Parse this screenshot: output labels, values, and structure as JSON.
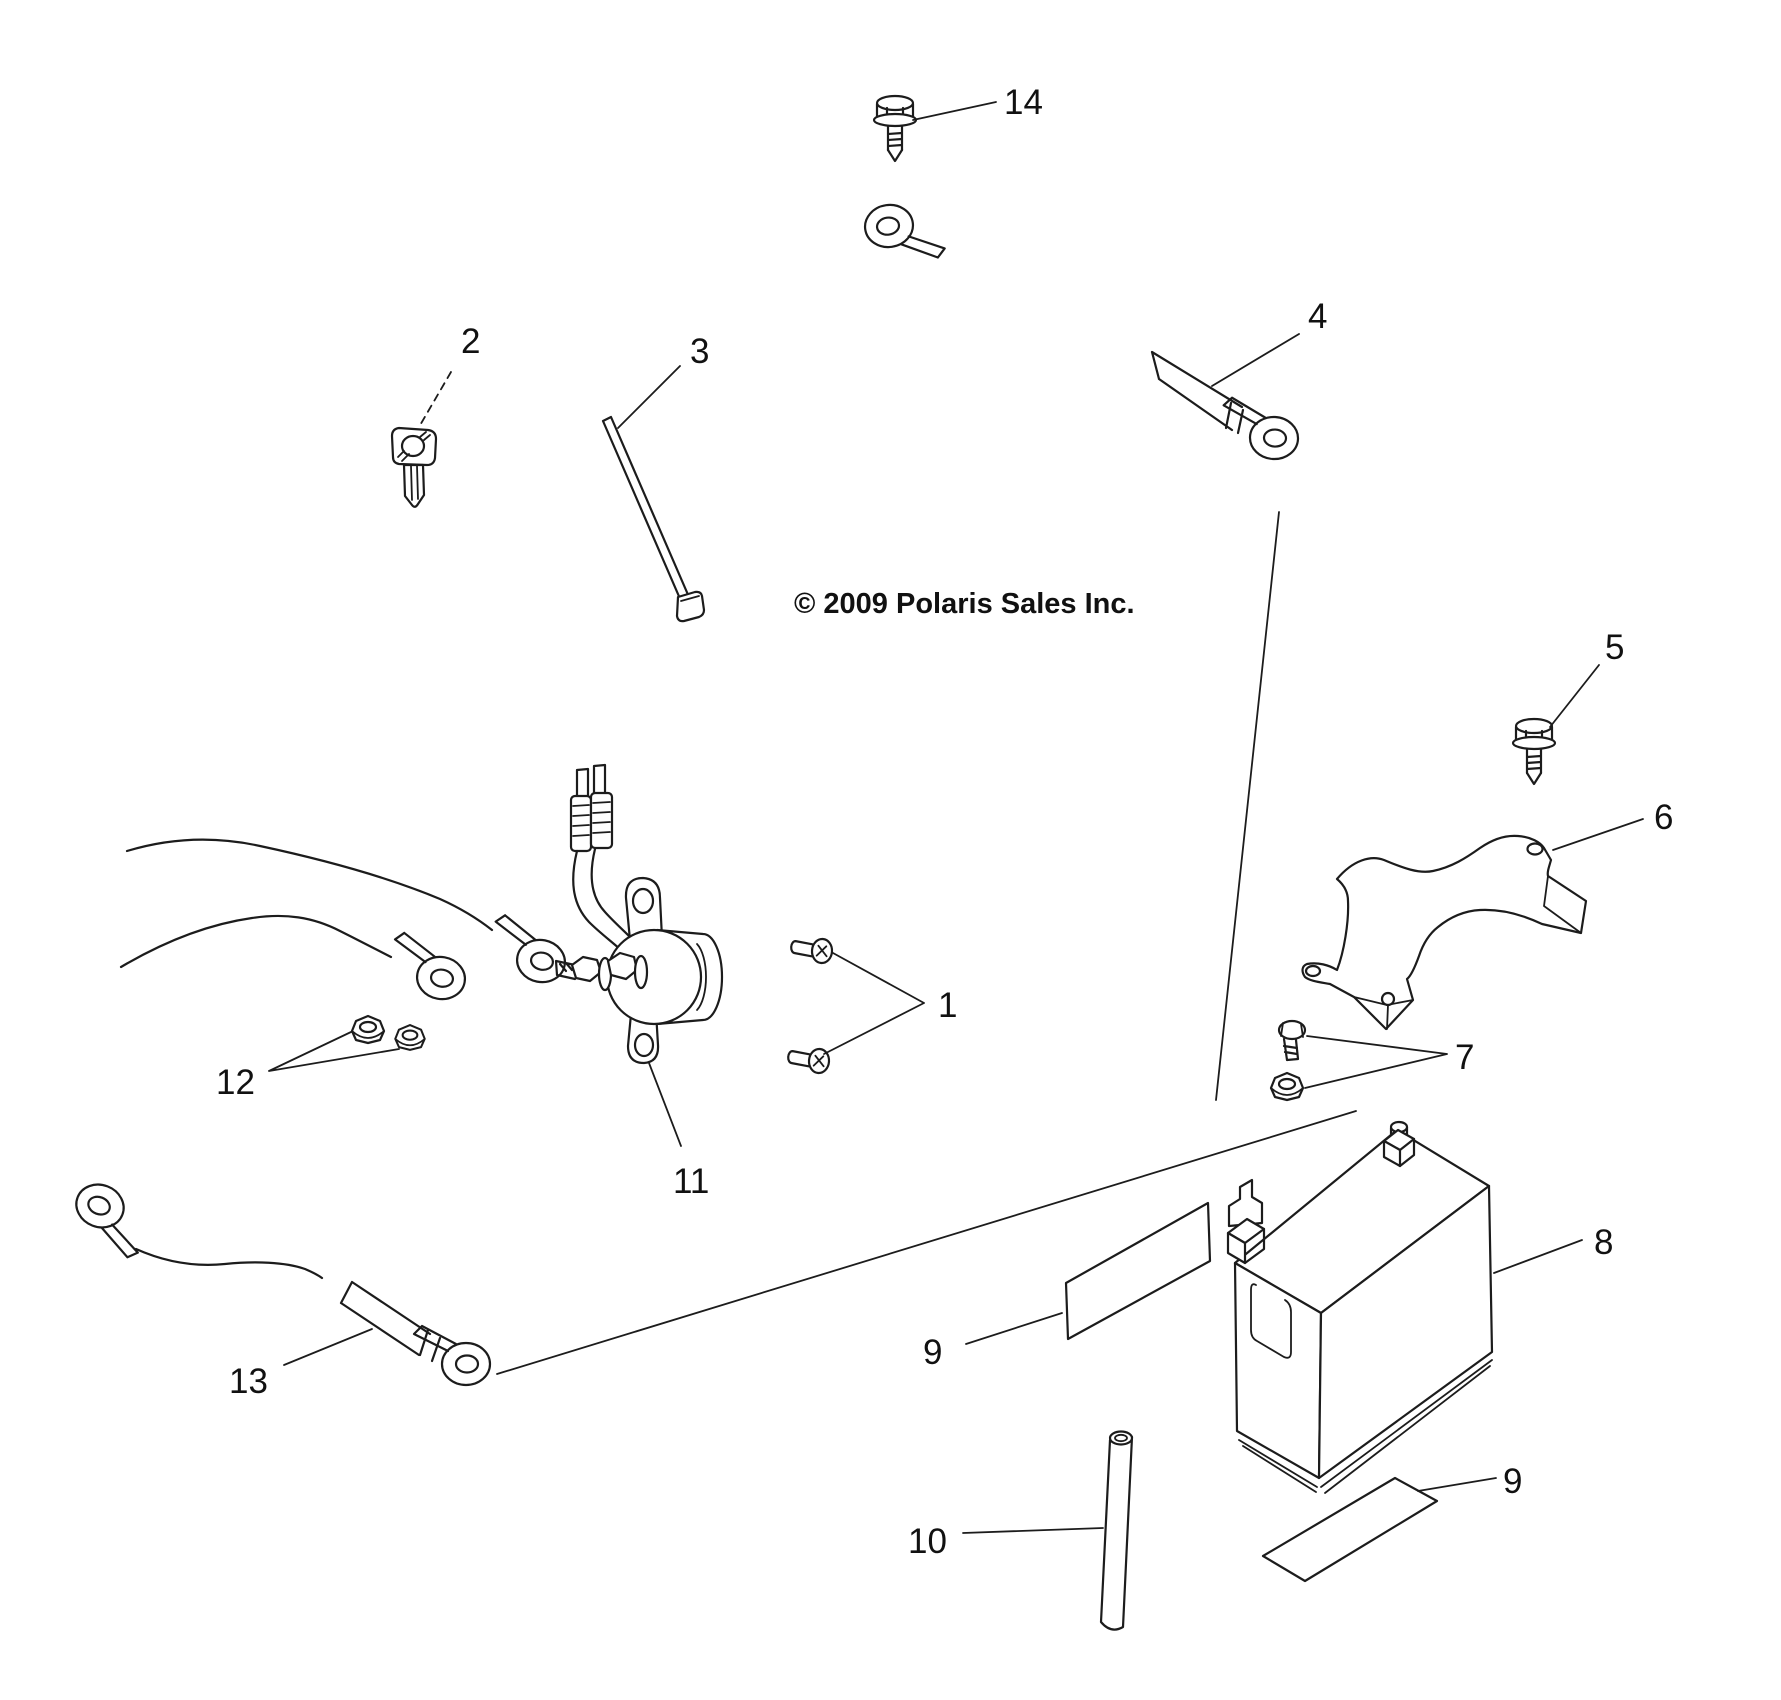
{
  "canvas": {
    "width": 1781,
    "height": 1700,
    "background_color": "#ffffff",
    "line_color": "#1c1c1c"
  },
  "diagram": {
    "copyright": "© 2009 Polaris Sales Inc.",
    "callouts": {
      "c1": "1",
      "c2": "2",
      "c3": "3",
      "c4": "4",
      "c5": "5",
      "c6": "6",
      "c7": "7",
      "c8": "8",
      "c9": "9",
      "c10": "10",
      "c11": "11",
      "c12": "12",
      "c13": "13",
      "c14": "14"
    },
    "parts": {
      "p1": "pan-head-screws",
      "p2": "key-blank",
      "p3": "cable-tie",
      "p4": "positive-battery-cable",
      "p5": "flange-bolt",
      "p6": "battery-hold-down-bracket",
      "p7": "bolt-and-flange-nut",
      "p8": "battery",
      "p9": "labels",
      "p10": "vent-tube",
      "p11": "starter-solenoid",
      "p12": "flange-nuts",
      "p13": "ground-cable",
      "p14": "flange-bolt"
    }
  }
}
